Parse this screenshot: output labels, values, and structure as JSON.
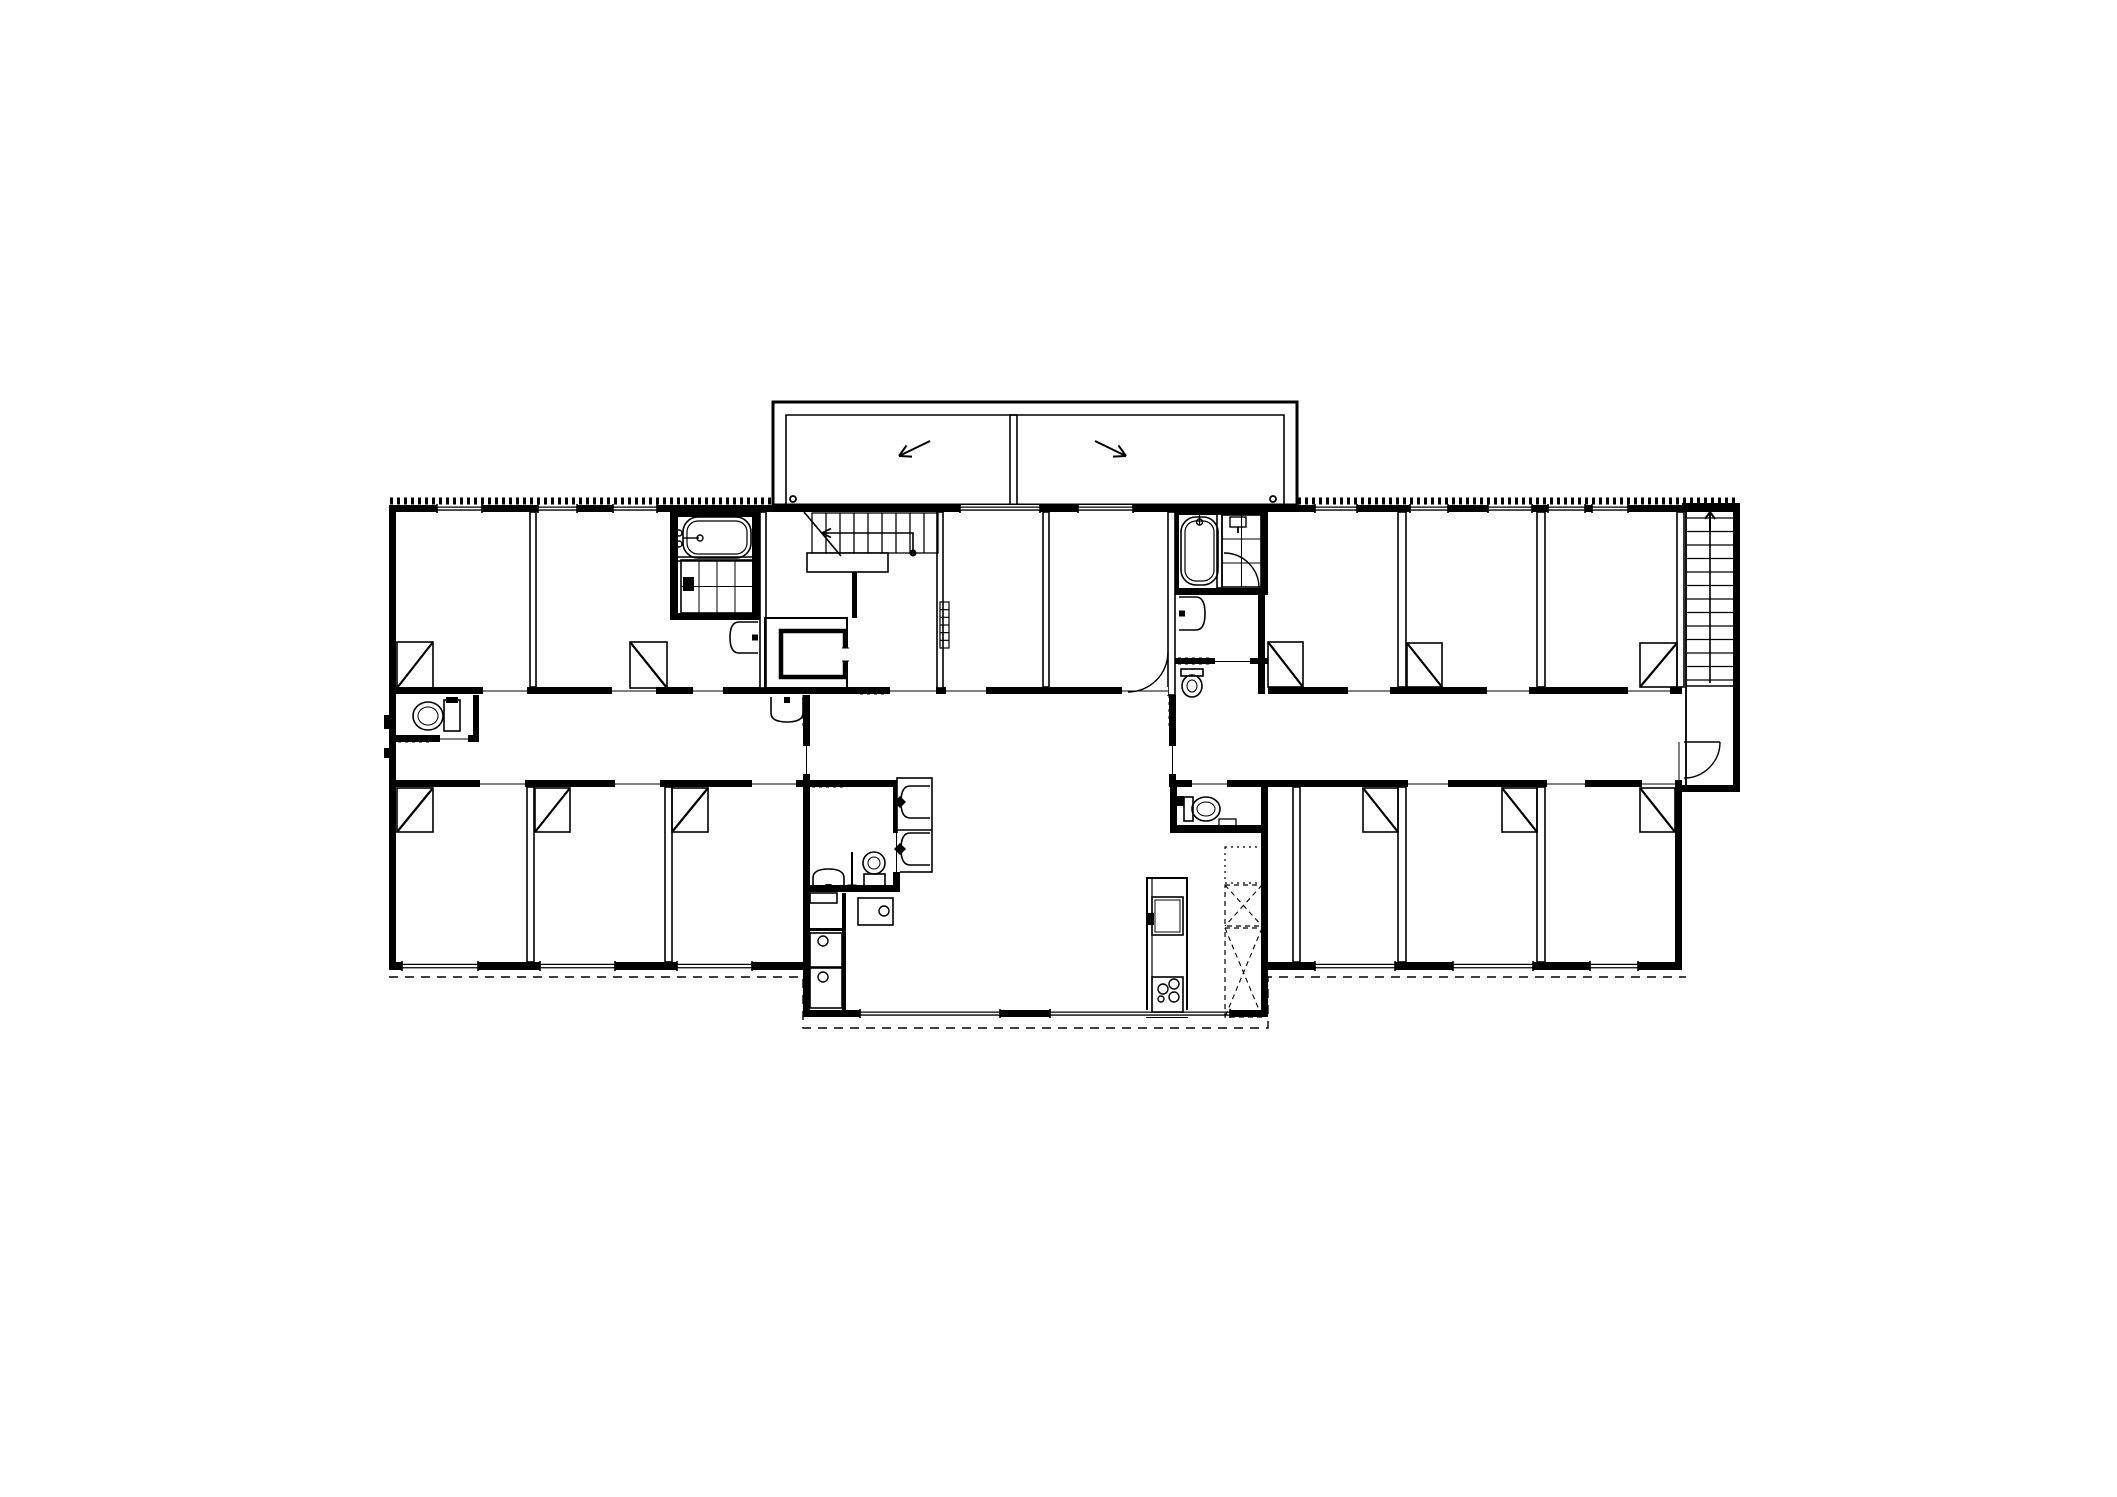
{
  "plan": {
    "kind": "architectural-floor-plan",
    "colors": {
      "ink": "#000000",
      "paper": "#ffffff"
    },
    "balcony": {
      "slope_arrows": [
        {
          "x1": 930,
          "y1": 441,
          "x2": 899,
          "y2": 456
        },
        {
          "x1": 1095,
          "y1": 441,
          "x2": 1126,
          "y2": 456
        }
      ],
      "drain_circles": [
        {
          "cx": 793,
          "cy": 499,
          "r": 3
        },
        {
          "cx": 1273,
          "cy": 499,
          "r": 3
        }
      ]
    },
    "beds": [
      {
        "x": 397,
        "y": 642,
        "w": 36,
        "h": 46,
        "d": "/"
      },
      {
        "x": 630,
        "y": 642,
        "w": 37,
        "h": 46,
        "d": "\\"
      },
      {
        "x": 1268,
        "y": 642,
        "w": 35,
        "h": 45,
        "d": "\\"
      },
      {
        "x": 1407,
        "y": 643,
        "w": 35,
        "h": 44,
        "d": "\\"
      },
      {
        "x": 1640,
        "y": 643,
        "w": 37,
        "h": 44,
        "d": "/"
      },
      {
        "x": 397,
        "y": 788,
        "w": 36,
        "h": 44,
        "d": "/"
      },
      {
        "x": 535,
        "y": 788,
        "w": 35,
        "h": 44,
        "d": "/"
      },
      {
        "x": 672,
        "y": 788,
        "w": 36,
        "h": 44,
        "d": "/"
      },
      {
        "x": 1363,
        "y": 788,
        "w": 35,
        "h": 44,
        "d": "\\"
      },
      {
        "x": 1502,
        "y": 788,
        "w": 35,
        "h": 44,
        "d": "\\"
      },
      {
        "x": 1640,
        "y": 788,
        "w": 35,
        "h": 44,
        "d": "\\"
      }
    ],
    "windows": [
      {
        "x": 437,
        "y": 505,
        "w": 45,
        "t": 7
      },
      {
        "x": 538,
        "y": 505,
        "w": 39,
        "t": 7
      },
      {
        "x": 613,
        "y": 505,
        "w": 44,
        "t": 7
      },
      {
        "x": 960,
        "y": 505,
        "w": 80,
        "t": 7
      },
      {
        "x": 1078,
        "y": 505,
        "w": 55,
        "t": 7
      },
      {
        "x": 1315,
        "y": 505,
        "w": 42,
        "t": 7
      },
      {
        "x": 1410,
        "y": 505,
        "w": 38,
        "t": 7
      },
      {
        "x": 1488,
        "y": 505,
        "w": 44,
        "t": 7
      },
      {
        "x": 1548,
        "y": 505,
        "w": 37,
        "t": 7
      },
      {
        "x": 1592,
        "y": 505,
        "w": 36,
        "t": 7
      },
      {
        "x": 402,
        "y": 962,
        "w": 76,
        "t": 8
      },
      {
        "x": 540,
        "y": 962,
        "w": 75,
        "t": 8
      },
      {
        "x": 677,
        "y": 962,
        "w": 75,
        "t": 8
      },
      {
        "x": 1315,
        "y": 962,
        "w": 80,
        "t": 8
      },
      {
        "x": 1453,
        "y": 962,
        "w": 80,
        "t": 8
      },
      {
        "x": 1590,
        "y": 962,
        "w": 48,
        "t": 8
      },
      {
        "x": 860,
        "y": 1010,
        "w": 140,
        "t": 7
      },
      {
        "x": 1050,
        "y": 1010,
        "w": 180,
        "t": 7
      }
    ],
    "openings": [
      {
        "x": 483,
        "y": 687,
        "w": 44,
        "h": 8
      },
      {
        "x": 612,
        "y": 687,
        "w": 44,
        "h": 8
      },
      {
        "x": 693,
        "y": 687,
        "w": 30,
        "h": 8
      },
      {
        "x": 890,
        "y": 687,
        "w": 46,
        "h": 8
      },
      {
        "x": 946,
        "y": 687,
        "w": 40,
        "h": 8
      },
      {
        "x": 1122,
        "y": 687,
        "w": 46,
        "h": 8
      },
      {
        "x": 1348,
        "y": 687,
        "w": 42,
        "h": 8
      },
      {
        "x": 1487,
        "y": 687,
        "w": 42,
        "h": 8
      },
      {
        "x": 1628,
        "y": 687,
        "w": 42,
        "h": 8
      },
      {
        "x": 480,
        "y": 780,
        "w": 45,
        "h": 8
      },
      {
        "x": 615,
        "y": 780,
        "w": 45,
        "h": 8
      },
      {
        "x": 752,
        "y": 780,
        "w": 44,
        "h": 8
      },
      {
        "x": 1192,
        "y": 780,
        "w": 35,
        "h": 8
      },
      {
        "x": 1408,
        "y": 780,
        "w": 40,
        "h": 8
      },
      {
        "x": 1547,
        "y": 780,
        "w": 38,
        "h": 8
      },
      {
        "x": 1642,
        "y": 780,
        "w": 33,
        "h": 8
      },
      {
        "x": 440,
        "y": 735,
        "w": 28,
        "h": 8
      },
      {
        "x": 1215,
        "y": 658,
        "w": 35,
        "h": 7
      },
      {
        "x": 893,
        "y": 833,
        "w": 7,
        "h": 39
      },
      {
        "x": 1675,
        "y": 742,
        "w": 8,
        "h": 38
      },
      {
        "x": 803,
        "y": 746,
        "w": 7,
        "h": 28
      },
      {
        "x": 1169,
        "y": 746,
        "w": 7,
        "h": 28
      }
    ],
    "transoms": [
      {
        "x1": 437,
        "x2": 480,
        "y": 784
      },
      {
        "x1": 565,
        "x2": 613,
        "y": 784
      },
      {
        "x1": 700,
        "x2": 748,
        "y": 784
      },
      {
        "x1": 1315,
        "x2": 1403,
        "y": 784
      },
      {
        "x1": 1455,
        "x2": 1535,
        "y": 784
      },
      {
        "x1": 1592,
        "x2": 1638,
        "y": 784
      }
    ],
    "hatches": [
      {
        "x1": 390,
        "y1": 501,
        "x2": 772,
        "y2": 501
      },
      {
        "x1": 1298,
        "y1": 501,
        "x2": 1739,
        "y2": 501
      },
      {
        "x1": 806,
        "y1": 695,
        "x2": 806,
        "y2": 729
      },
      {
        "x1": 1172,
        "y1": 695,
        "x2": 1172,
        "y2": 729
      },
      {
        "x1": 860,
        "y1": 691,
        "x2": 888,
        "y2": 691
      },
      {
        "x1": 812,
        "y1": 784,
        "x2": 845,
        "y2": 784
      },
      {
        "x1": 398,
        "y1": 739,
        "x2": 433,
        "y2": 739
      },
      {
        "x1": 1178,
        "y1": 661,
        "x2": 1212,
        "y2": 661
      }
    ],
    "eaves": "389,977 803,977 803,1028 1268,1028 1268,977 1686,977",
    "arcs": [
      {
        "d": "M1168,652 A40,40 0 0 1 1128,692"
      },
      {
        "d": "M1224,553 A35,35 0 0 1 1259,588"
      },
      {
        "d": "M1720,742 A36,36 0 0 1 1684,778",
        "leaf": "M1684,742 L1720,742"
      }
    ],
    "stairs": {
      "main": {
        "tx0": 812,
        "step": 14,
        "count": 10,
        "y1": 513,
        "y2": 553,
        "landing": {
          "x": 807,
          "y": 553,
          "w": 81,
          "h": 19
        },
        "stub": {
          "x": 852,
          "y": 572,
          "w": 5,
          "h": 46
        },
        "walk": "M913,553 L913,533 L822,533",
        "dot": {
          "cx": 913,
          "cy": 553,
          "r": 3.5
        },
        "head": [
          [
            831,
            528.5
          ],
          [
            831,
            537.5
          ]
        ],
        "headAt": [
          822,
          533
        ],
        "brk": "M804,512 L841,556"
      },
      "right": {
        "x1": 1687,
        "x2": 1733,
        "ty0": 518,
        "step": 13.5,
        "count": 13,
        "stringer": {
          "x": 1710,
          "y1": 508,
          "y2": 683
        },
        "rail": "M1687,686 L1733,686",
        "side": "M1686,510 L1686,785",
        "arrow": "M1710,532 L1710,512",
        "head": [
          [
            1705,
            519
          ],
          [
            1715,
            519
          ]
        ],
        "headAt": [
          1710,
          512
        ]
      }
    },
    "fixtures": [
      {
        "type": "bathtub",
        "name": "bathtub-left",
        "x": 683,
        "y": 517,
        "w": 68,
        "h": 41,
        "o": "h"
      },
      {
        "type": "shower",
        "name": "shower-left",
        "x": 681,
        "y": 560,
        "w": 72,
        "h": 53,
        "cols": 4,
        "rows": 2,
        "valve": [
          683,
          577,
          11,
          14
        ]
      },
      {
        "type": "sinkD",
        "name": "sink-left-bath",
        "x": 730,
        "y": 622,
        "w": 28,
        "h": 31,
        "dir": "left"
      },
      {
        "type": "toilet",
        "name": "toilet-corridor-left",
        "tank": [
          444,
          700,
          16,
          31
        ],
        "cap": [
          446,
          697,
          12,
          6
        ],
        "bowl": [
          428,
          716,
          15,
          14
        ]
      },
      {
        "type": "sinkD",
        "name": "sink-stair-hall",
        "x": 771,
        "y": 697,
        "w": 32,
        "h": 25,
        "dir": "down"
      },
      {
        "type": "radiator",
        "name": "radiator-stair-hall",
        "x": 940,
        "y": 602,
        "w": 9,
        "h": 46,
        "rungs": 6
      },
      {
        "type": "bathtub",
        "name": "bathtub-right",
        "x": 1181,
        "y": 517,
        "w": 37,
        "h": 68,
        "o": "v"
      },
      {
        "type": "shower",
        "name": "shower-right",
        "x": 1222,
        "y": 515,
        "w": 39,
        "h": 72,
        "cols": 2,
        "rows": 3,
        "head": [
          1230,
          517,
          16,
          10
        ]
      },
      {
        "type": "sinkD",
        "name": "sink-right-bath",
        "x": 1179,
        "y": 597,
        "w": 26,
        "h": 33,
        "dir": "right"
      },
      {
        "type": "toilet",
        "name": "toilet-right-nook",
        "tank": [
          1181,
          669,
          22,
          7
        ],
        "bowl": [
          1192,
          686,
          10,
          11
        ]
      },
      {
        "type": "sinkD",
        "name": "washroom-sink",
        "x": 813,
        "y": 869,
        "w": 31,
        "h": 21,
        "dir": "up"
      },
      {
        "type": "toilet",
        "name": "washroom-toilet",
        "tank": [
          864,
          874,
          21,
          13
        ],
        "bowl": [
          874,
          863,
          11,
          11
        ]
      },
      {
        "type": "mop",
        "name": "cleaning-stand",
        "x": 852,
        "y1": 852,
        "y2": 888
      },
      {
        "type": "basin",
        "name": "wash-basin-1",
        "x": 901,
        "y": 786,
        "w": 29,
        "h": 32
      },
      {
        "type": "basin",
        "name": "wash-basin-2",
        "x": 901,
        "y": 833,
        "w": 29,
        "h": 32
      },
      {
        "type": "shelf",
        "name": "laundry-shelf",
        "x": 810,
        "y": 893,
        "w": 27,
        "h": 10
      },
      {
        "type": "washer",
        "name": "washer-1",
        "x": 858,
        "y": 898,
        "w": 35,
        "h": 27,
        "c": [
          884,
          911,
          5
        ]
      },
      {
        "type": "washer",
        "name": "washer-2",
        "x": 810,
        "y": 933,
        "w": 32,
        "h": 34,
        "c": [
          823,
          941,
          5
        ]
      },
      {
        "type": "washer",
        "name": "washer-3",
        "x": 810,
        "y": 968,
        "w": 32,
        "h": 40,
        "c": [
          823,
          977,
          5
        ]
      },
      {
        "type": "ksink",
        "name": "kitchen-sink",
        "x": 1152,
        "y": 897,
        "w": 31,
        "h": 38,
        "tap": [
          1147,
          913,
          7,
          12
        ]
      },
      {
        "type": "cooktop",
        "name": "cooktop",
        "x": 1152,
        "y": 977,
        "w": 31,
        "h": 35,
        "burners": [
          [
            1163,
            989,
            5
          ],
          [
            1174,
            984,
            5
          ],
          [
            1174,
            997,
            5
          ],
          [
            1161,
            999,
            3
          ]
        ]
      },
      {
        "type": "toilet",
        "name": "toilet-room-right",
        "tank": [
          1184,
          797,
          9,
          24
        ],
        "cap": [
          1176,
          796,
          8,
          10
        ],
        "bowl": [
          1206,
          809,
          14,
          12
        ]
      },
      {
        "type": "box",
        "name": "toilet-room-shelf",
        "x": 1219,
        "y": 819,
        "w": 17,
        "h": 9
      },
      {
        "type": "elevator",
        "name": "elevator-car",
        "x": 781,
        "y": 631,
        "w": 64,
        "h": 46,
        "open": [
          842,
          648,
          7,
          13
        ]
      },
      {
        "type": "dotbox",
        "name": "closet-dotted",
        "x": 1225,
        "y": 847,
        "w": 37,
        "h": 36
      },
      {
        "type": "xbox",
        "name": "closet-x-upper",
        "x": 1225,
        "y": 885,
        "w": 37,
        "h": 41
      },
      {
        "type": "xbox",
        "name": "closet-x-lower",
        "x": 1225,
        "y": 928,
        "w": 37,
        "h": 89
      }
    ]
  }
}
